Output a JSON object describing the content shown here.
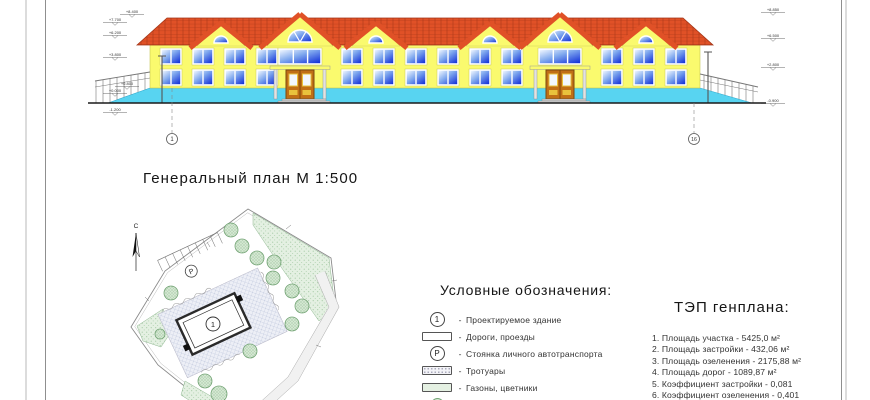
{
  "colors": {
    "wall": "#FAFA6E",
    "wall_edge": "#C9C955",
    "roof": "#E05127",
    "roof_dark": "#A33517",
    "glass_light": "#F2F8FF",
    "glass_mid": "#7FA8EE",
    "glass_dark": "#0E2BD8",
    "plinth": "#58D4F1",
    "plinth_edge": "#2FA9CE",
    "door": "#C06F16",
    "door_dark": "#7C4A0C",
    "door_panel": "#E9C23C",
    "step": "#CFCFCF",
    "ink": "#1A1A1A",
    "line_gray": "#8A8A8A",
    "green_fill": "#E4F0E2",
    "green_dot": "#9CC49C",
    "tree_fill": "#D4E8D2",
    "tree_edge": "#74A476",
    "hatch_bg": "#EDEFF6",
    "hatch_line": "#BCC4DA",
    "road_fill": "#F1F1F1"
  },
  "elevation": {
    "marks_left": [
      "+8.400",
      "+7.700",
      "+6.200",
      "+3.800",
      "+0.800",
      "+0.000",
      "-1.200"
    ],
    "marks_right": [
      "+8.850",
      "+6.500",
      "+2.800",
      "-0.900"
    ],
    "axis_left": "1",
    "axis_right": "16"
  },
  "site_plan": {
    "title": "Генеральный план М 1:500",
    "north_label": "С",
    "building_label": "1",
    "parking_label": "P"
  },
  "legend": {
    "title": "Условные обозначения:",
    "dash": "-",
    "items": [
      {
        "symbol": "numbered-circle",
        "label": "Проектируемое здание"
      },
      {
        "symbol": "plain-rect",
        "label": "Дороги, проезды"
      },
      {
        "symbol": "p-circle",
        "label": "Стоянка личного автотранспорта"
      },
      {
        "symbol": "stippled-rect",
        "label": "Тротуары"
      },
      {
        "symbol": "green-rect",
        "label": "Газоны, цветники"
      },
      {
        "symbol": "tree-circle",
        "label": "Деревья и кустарники"
      }
    ]
  },
  "tep": {
    "title": "ТЭП генплана:",
    "items": [
      "1. Площадь участка - 5425,0 м²",
      "2. Площадь застройки - 432,06 м²",
      "3. Площадь озеленения - 2175,88 м²",
      "4. Площадь дорог - 1089,87 м²",
      "5. Коэффициент застройки - 0,081",
      "6. Коэффициент озеленения - 0,401"
    ]
  }
}
